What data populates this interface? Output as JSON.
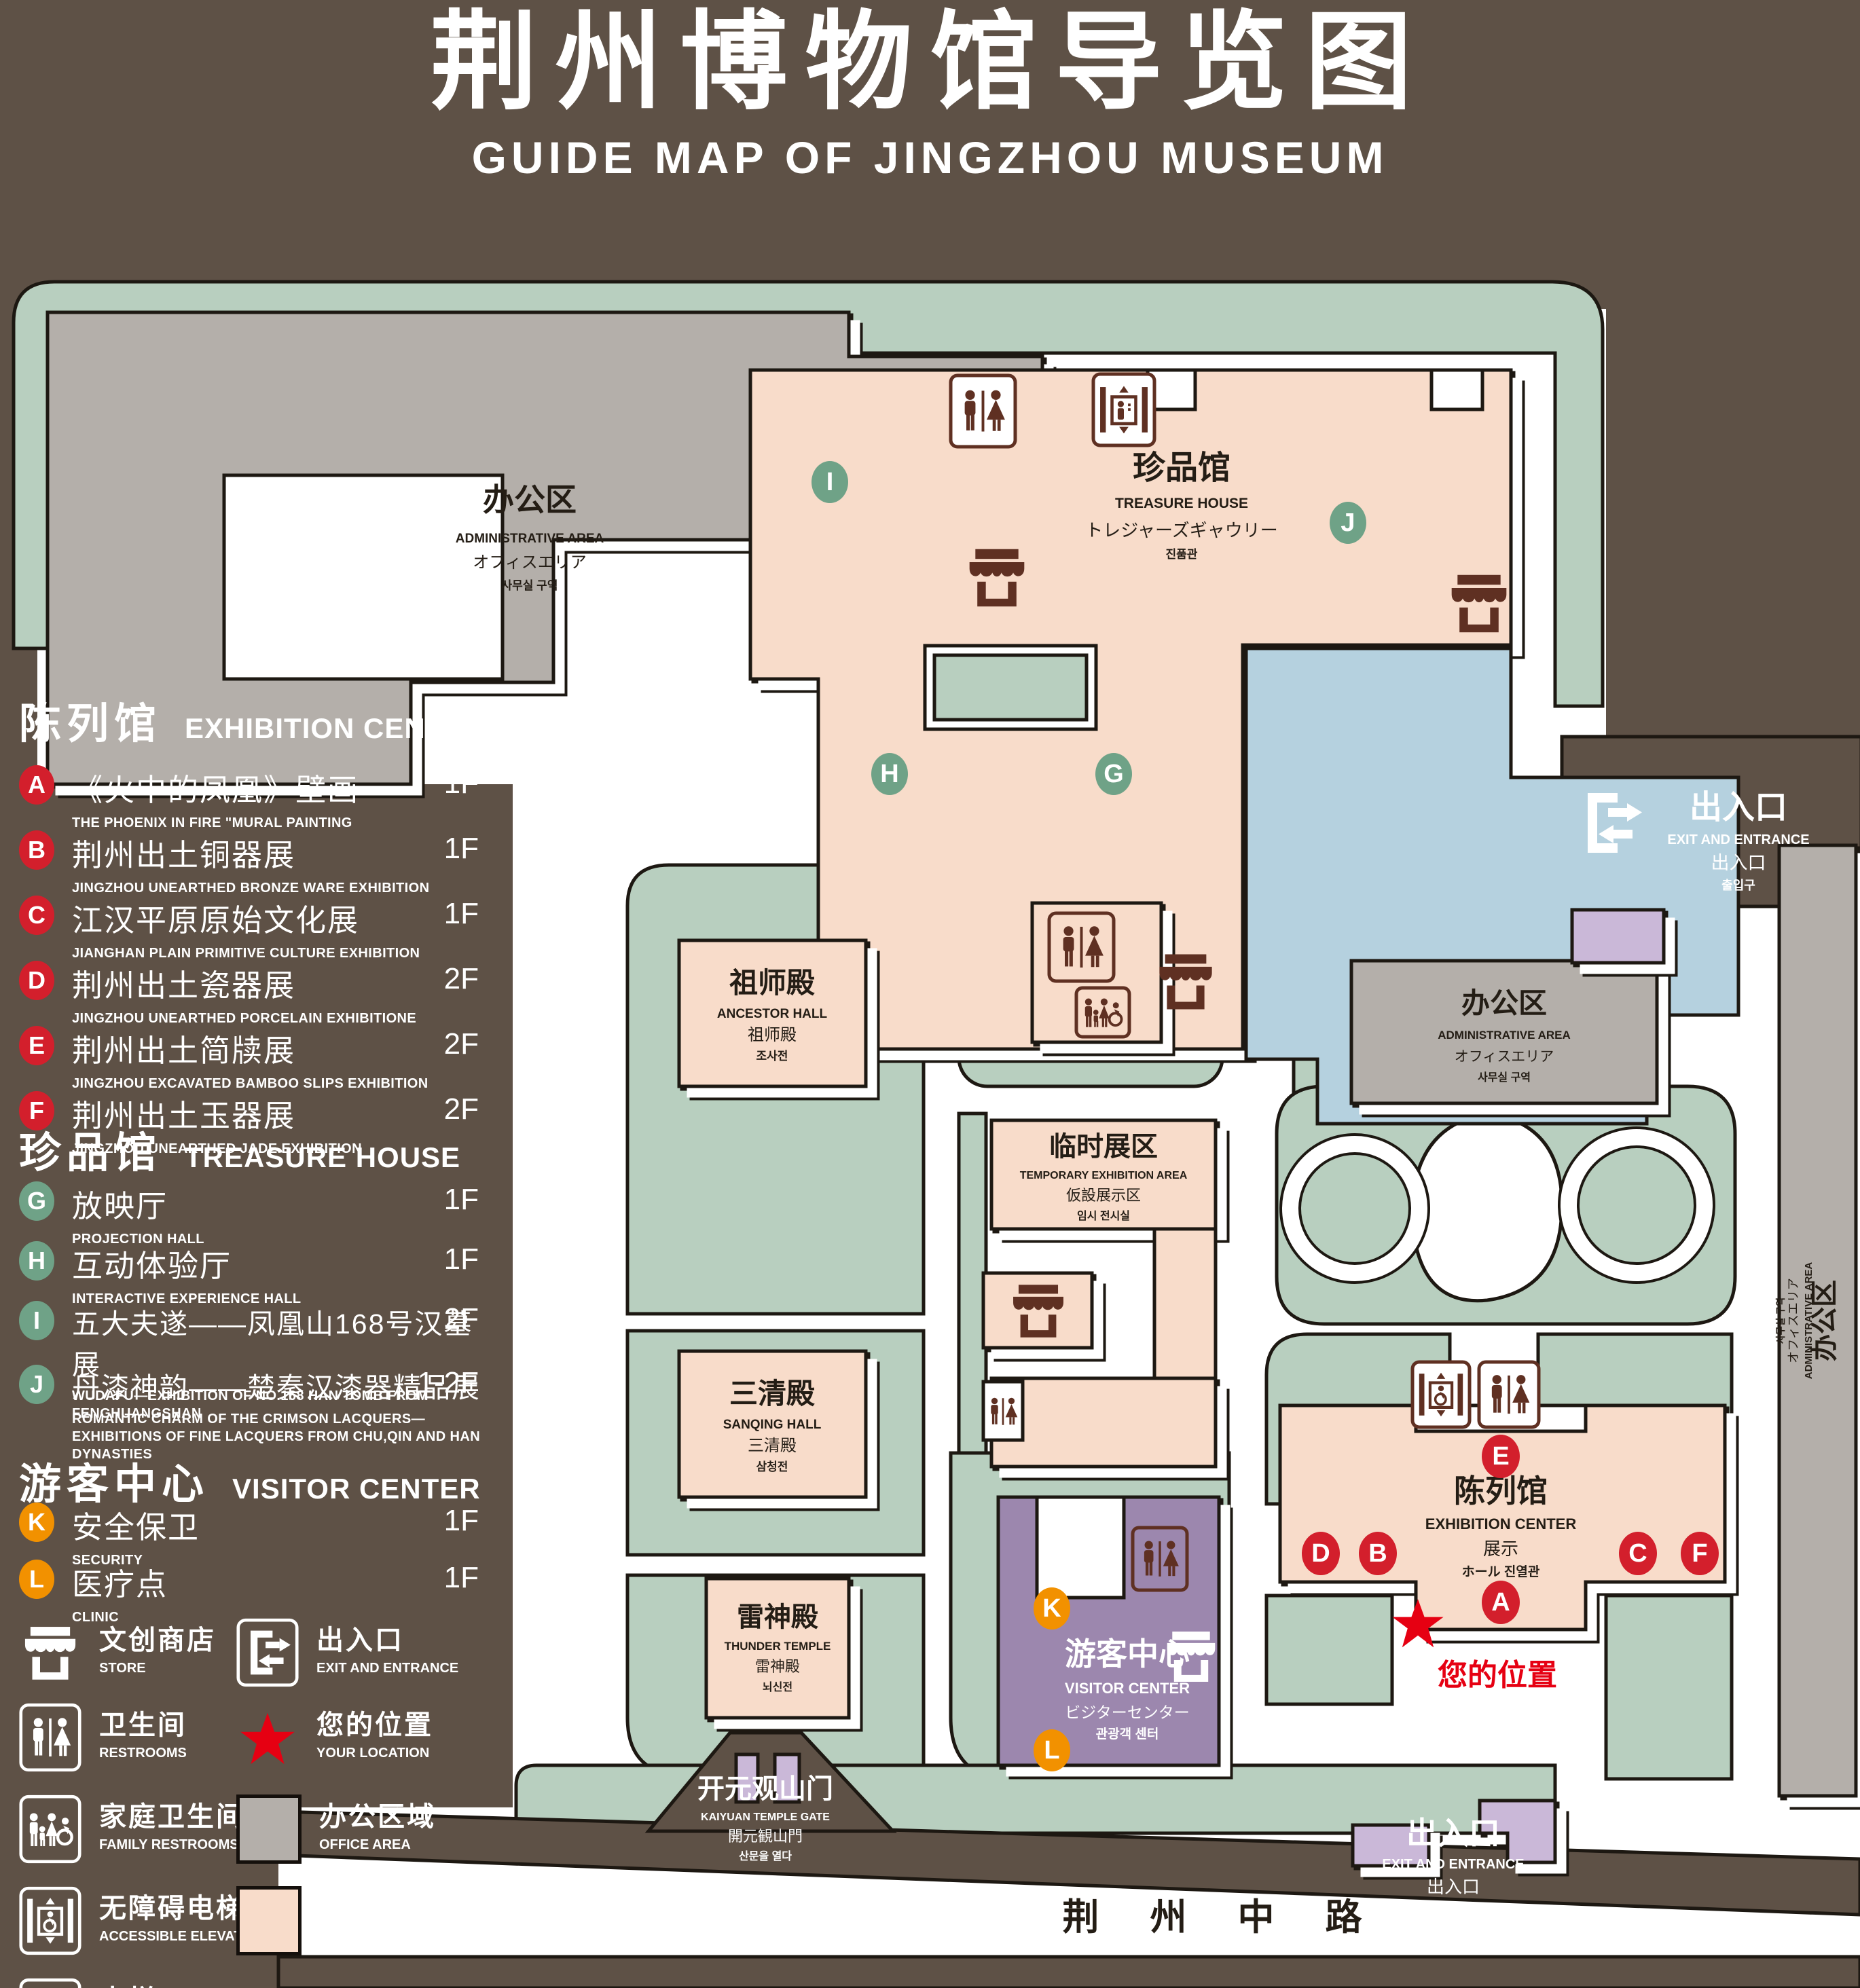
{
  "title": {
    "zh": "荆州博物馆导览图",
    "en": "GUIDE MAP OF JINGZHOU MUSEUM"
  },
  "colors": {
    "background_brown": "#5e5146",
    "campus_green": "#b8cfbf",
    "display_pink": "#f8dcca",
    "office_gray": "#b4afaa",
    "lake_blue": "#b5d1df",
    "visitor_purple": "#9c87ae",
    "gate_purple": "#cab8d8",
    "marker_red": "#d31f2c",
    "marker_green": "#6fa287",
    "marker_orange": "#f29100",
    "icon_brown": "#5f3022",
    "location_red": "#e60012"
  },
  "legend": {
    "exhibition": {
      "zh": "陈列馆",
      "en": "EXHIBITION CENTER",
      "items": [
        {
          "key": "A",
          "zh": "《火中的凤凰》壁画",
          "en": "THE PHOENIX IN FIRE \"MURAL PAINTING",
          "floor": "1F"
        },
        {
          "key": "B",
          "zh": "荆州出土铜器展",
          "en": "JINGZHOU UNEARTHED BRONZE WARE EXHIBITION",
          "floor": "1F"
        },
        {
          "key": "C",
          "zh": "江汉平原原始文化展",
          "en": "JIANGHAN PLAIN PRIMITIVE CULTURE EXHIBITION",
          "floor": "1F"
        },
        {
          "key": "D",
          "zh": "荆州出土瓷器展",
          "en": "JINGZHOU UNEARTHED PORCELAIN EXHIBITIONE",
          "floor": "2F"
        },
        {
          "key": "E",
          "zh": "荆州出土简牍展",
          "en": "JINGZHOU EXCAVATED BAMBOO SLIPS EXHIBITION",
          "floor": "2F"
        },
        {
          "key": "F",
          "zh": "荆州出土玉器展",
          "en": "JINGZHOU UNEARTHED JADE EXHIBITION",
          "floor": "2F"
        }
      ]
    },
    "treasure": {
      "zh": "珍品馆",
      "en": "TREASURE HOUSE",
      "items": [
        {
          "key": "G",
          "zh": "放映厅",
          "en": "PROJECTION HALL",
          "floor": "1F"
        },
        {
          "key": "H",
          "zh": "互动体验厅",
          "en": "INTERACTIVE EXPERIENCE HALL",
          "floor": "1F"
        },
        {
          "key": "I",
          "zh": "五大夫遂——凤凰山168号汉墓展",
          "en": "WUDAFU—EXHIBITION OF NO.168 HAN TOMB FROM FENGHUANGSHAN",
          "floor": "2F"
        },
        {
          "key": "J",
          "zh": "丹漆神韵——楚秦汉漆器精品展",
          "en": "ROMANTIC CHARM OF THE CRIMSON LACQUERS—EXHIBITIONS OF FINE LACQUERS FROM CHU,QIN AND HAN DYNASTIES",
          "floor": "1-2F"
        }
      ]
    },
    "visitor": {
      "zh": "游客中心",
      "en": "VISITOR CENTER",
      "items": [
        {
          "key": "K",
          "zh": "安全保卫",
          "en": "SECURITY",
          "floor": "1F"
        },
        {
          "key": "L",
          "zh": "医疗点",
          "en": "CLINIC",
          "floor": "1F"
        }
      ]
    },
    "symbols": {
      "store": {
        "zh": "文创商店",
        "en": "STORE"
      },
      "restrooms": {
        "zh": "卫生间",
        "en": "RESTROOMS"
      },
      "family_restrooms": {
        "zh": "家庭卫生间",
        "en": "FAMILY RESTROOMS"
      },
      "accessible_elevator": {
        "zh": "无障碍电梯",
        "en": "ACCESSIBLE ELEVATOR"
      },
      "elevator": {
        "zh": "电梯",
        "en": "Elevator"
      },
      "exit": {
        "zh": "出入口",
        "en": "EXIT AND ENTRANCE"
      },
      "your_location": {
        "zh": "您的位置",
        "en": "YOUR LOCATION"
      },
      "office_area": {
        "zh": "办公区域",
        "en": "OFFICE AREA"
      },
      "display_area": {
        "zh": "展示区域",
        "en": "DISPLAY AREA"
      }
    }
  },
  "map": {
    "admin_area": {
      "zh": "办公区",
      "en": "ADMINISTRATIVE AREA",
      "ja": "オフィスエリア",
      "ko": "사무실 구역"
    },
    "treasure_house": {
      "zh": "珍品馆",
      "en": "TREASURE HOUSE",
      "ja": "トレジャーズギャウリー",
      "ko": "진품관"
    },
    "ancestor_hall": {
      "zh": "祖师殿",
      "en": "ANCESTOR HALL",
      "ja": "祖师殿",
      "ko": "조사전"
    },
    "sanqing_hall": {
      "zh": "三清殿",
      "en": "SANQING HALL",
      "ja": "三清殿",
      "ko": "삼청전"
    },
    "thunder_temple": {
      "zh": "雷神殿",
      "en": "THUNDER TEMPLE",
      "ja": "雷神殿",
      "ko": "뇌신전"
    },
    "temporary_area": {
      "zh": "临时展区",
      "en": "TEMPORARY EXHIBITION AREA",
      "ja": "仮設展示区",
      "ko": "임시 전시실"
    },
    "exhibition_center": {
      "zh": "陈列馆",
      "en": "EXHIBITION CENTER",
      "l3": "展示",
      "l4": "ホール 진열관"
    },
    "visitor_center": {
      "zh": "游客中心",
      "en": "VISITOR CENTER",
      "ja": "ビジターセンター",
      "ko": "관광객 센터"
    },
    "exit": {
      "zh": "出入口",
      "en": "EXIT AND ENTRANCE",
      "ja": "出入口",
      "ko": "출입구"
    },
    "gate": {
      "zh": "开元观山门",
      "en": "KAIYUAN TEMPLE GATE",
      "ja": "開元観山門",
      "ko": "산문을 열다"
    },
    "road": "荆 州 中 路",
    "your_location": "您的位置",
    "markers": {
      "A": "A",
      "B": "B",
      "C": "C",
      "D": "D",
      "E": "E",
      "F": "F",
      "G": "G",
      "H": "H",
      "I": "I",
      "J": "J",
      "K": "K",
      "L": "L"
    }
  }
}
